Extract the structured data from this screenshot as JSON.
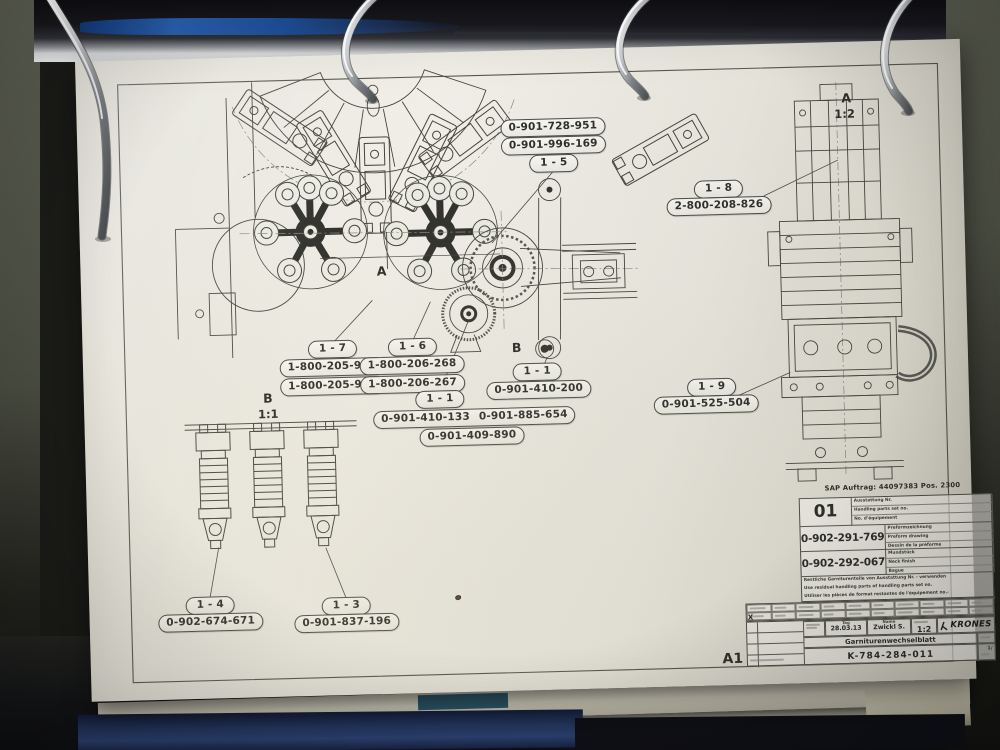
{
  "drawing": {
    "sap_line": "SAP Auftrag: 44097383 Pos. 2300",
    "view_labels": {
      "detail_a": "A",
      "detail_a_scale": "1:2",
      "section_a": "A",
      "section_b": "B",
      "detail_b": "B",
      "detail_b_scale": "1:1",
      "format": "A1"
    },
    "callouts": [
      {
        "tag": "1 - 5",
        "parts": [
          "0-901-728-951",
          "0-901-996-169"
        ]
      },
      {
        "tag": "1 - 8",
        "parts": [
          "2-800-208-826"
        ]
      },
      {
        "tag": "1 - 7",
        "parts": [
          "1-800-205-912",
          "1-800-205-913"
        ]
      },
      {
        "tag": "1 - 6",
        "parts": [
          "1-800-206-268",
          "1-800-206-267"
        ]
      },
      {
        "tag": "1 - 1",
        "parts": [
          "0-901-410-200"
        ]
      },
      {
        "tag": "1 - 1",
        "parts": [
          "0-901-410-133",
          "0-901-885-654",
          "0-901-409-890"
        ]
      },
      {
        "tag": "1 - 9",
        "parts": [
          "0-901-525-504"
        ]
      },
      {
        "tag": "1 - 4",
        "parts": [
          "0-902-674-671"
        ]
      },
      {
        "tag": "1 - 3",
        "parts": [
          "0-901-837-196"
        ]
      }
    ],
    "title_block": {
      "set_number": "01",
      "set_label_de": "Ausstattung Nr.",
      "set_label_en": "Handling parts set no.",
      "set_label_fr": "No. d'équipement",
      "preform_number": "0-902-291-769",
      "preform_label_de": "Preformzeichnung",
      "preform_label_en": "Preform drawing",
      "preform_label_fr": "Dessin de la préforme",
      "neck_number": "0-902-292-067",
      "neck_label_de": "Mundstück",
      "neck_label_en": "Neck finish",
      "neck_label_fr": "Bague",
      "note_de": "Restliche Garniturenteile von Ausstattung Nr. -  verwenden",
      "note_en": "Use residual handling parts of handling parts set no.",
      "note_fr": "Utiliser les pièces de format restantes de l'équipement no.-",
      "tolerance_mark": "X",
      "date_label": "Tag",
      "name_label": "Name",
      "date": "28.03.13",
      "name": "Zwickl S.",
      "scale": "1:2",
      "brand": "KRONES",
      "doc_title": "Garniturenwechselblatt",
      "doc_number": "K-784-284-011",
      "sheet": "1/"
    }
  },
  "colors": {
    "binder_blue": "#2a62b4",
    "cover_blue": "#24365e",
    "paper": "#efede5",
    "wall_olive": "#565a4e",
    "line_ink": "#45453e",
    "teal_tab": "#2d5a6e"
  }
}
